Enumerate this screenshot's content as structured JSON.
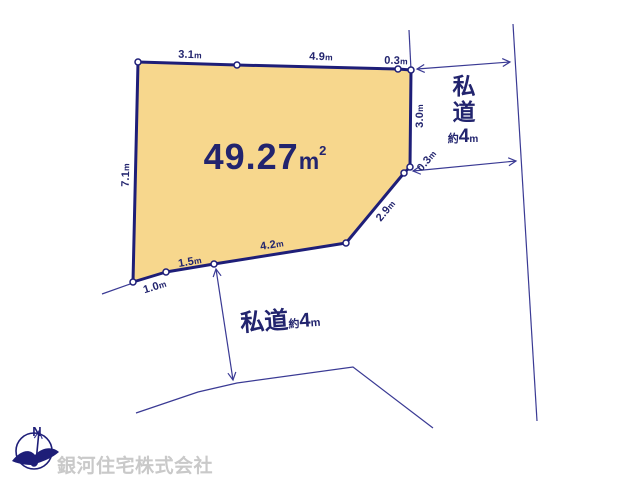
{
  "parcel": {
    "area": {
      "value": "49.27",
      "unit": "m",
      "exponent": "2"
    },
    "dimensions": {
      "top_1": {
        "value": "3.1",
        "unit": "m"
      },
      "top_2": {
        "value": "4.9",
        "unit": "m"
      },
      "top_3": {
        "value": "0.3",
        "unit": "m"
      },
      "right_1": {
        "value": "3.0",
        "unit": "m"
      },
      "right_2": {
        "value": "0.3",
        "unit": "m"
      },
      "right_3": {
        "value": "2.9",
        "unit": "m"
      },
      "bottom_1": {
        "value": "4.2",
        "unit": "m"
      },
      "bottom_2": {
        "value": "1.5",
        "unit": "m"
      },
      "bottom_3": {
        "value": "1.0",
        "unit": "m"
      },
      "left_1": {
        "value": "7.1",
        "unit": "m"
      }
    }
  },
  "right_road": {
    "name": "私道",
    "approx": "約",
    "width": "4",
    "unit": "m"
  },
  "bottom_road": {
    "name": "私道",
    "approx": "約",
    "width": "4",
    "unit": "m"
  },
  "compass": {
    "north": "N"
  },
  "watermark": {
    "company": "銀河住宅株式会社"
  },
  "colors": {
    "parcel_fill": "#f7d78d",
    "boundary_navy": "#1e1e78",
    "thin_line_navy": "#3a3a94",
    "text_navy": "#22246e",
    "watermark_gray": "#c9c9c9"
  }
}
